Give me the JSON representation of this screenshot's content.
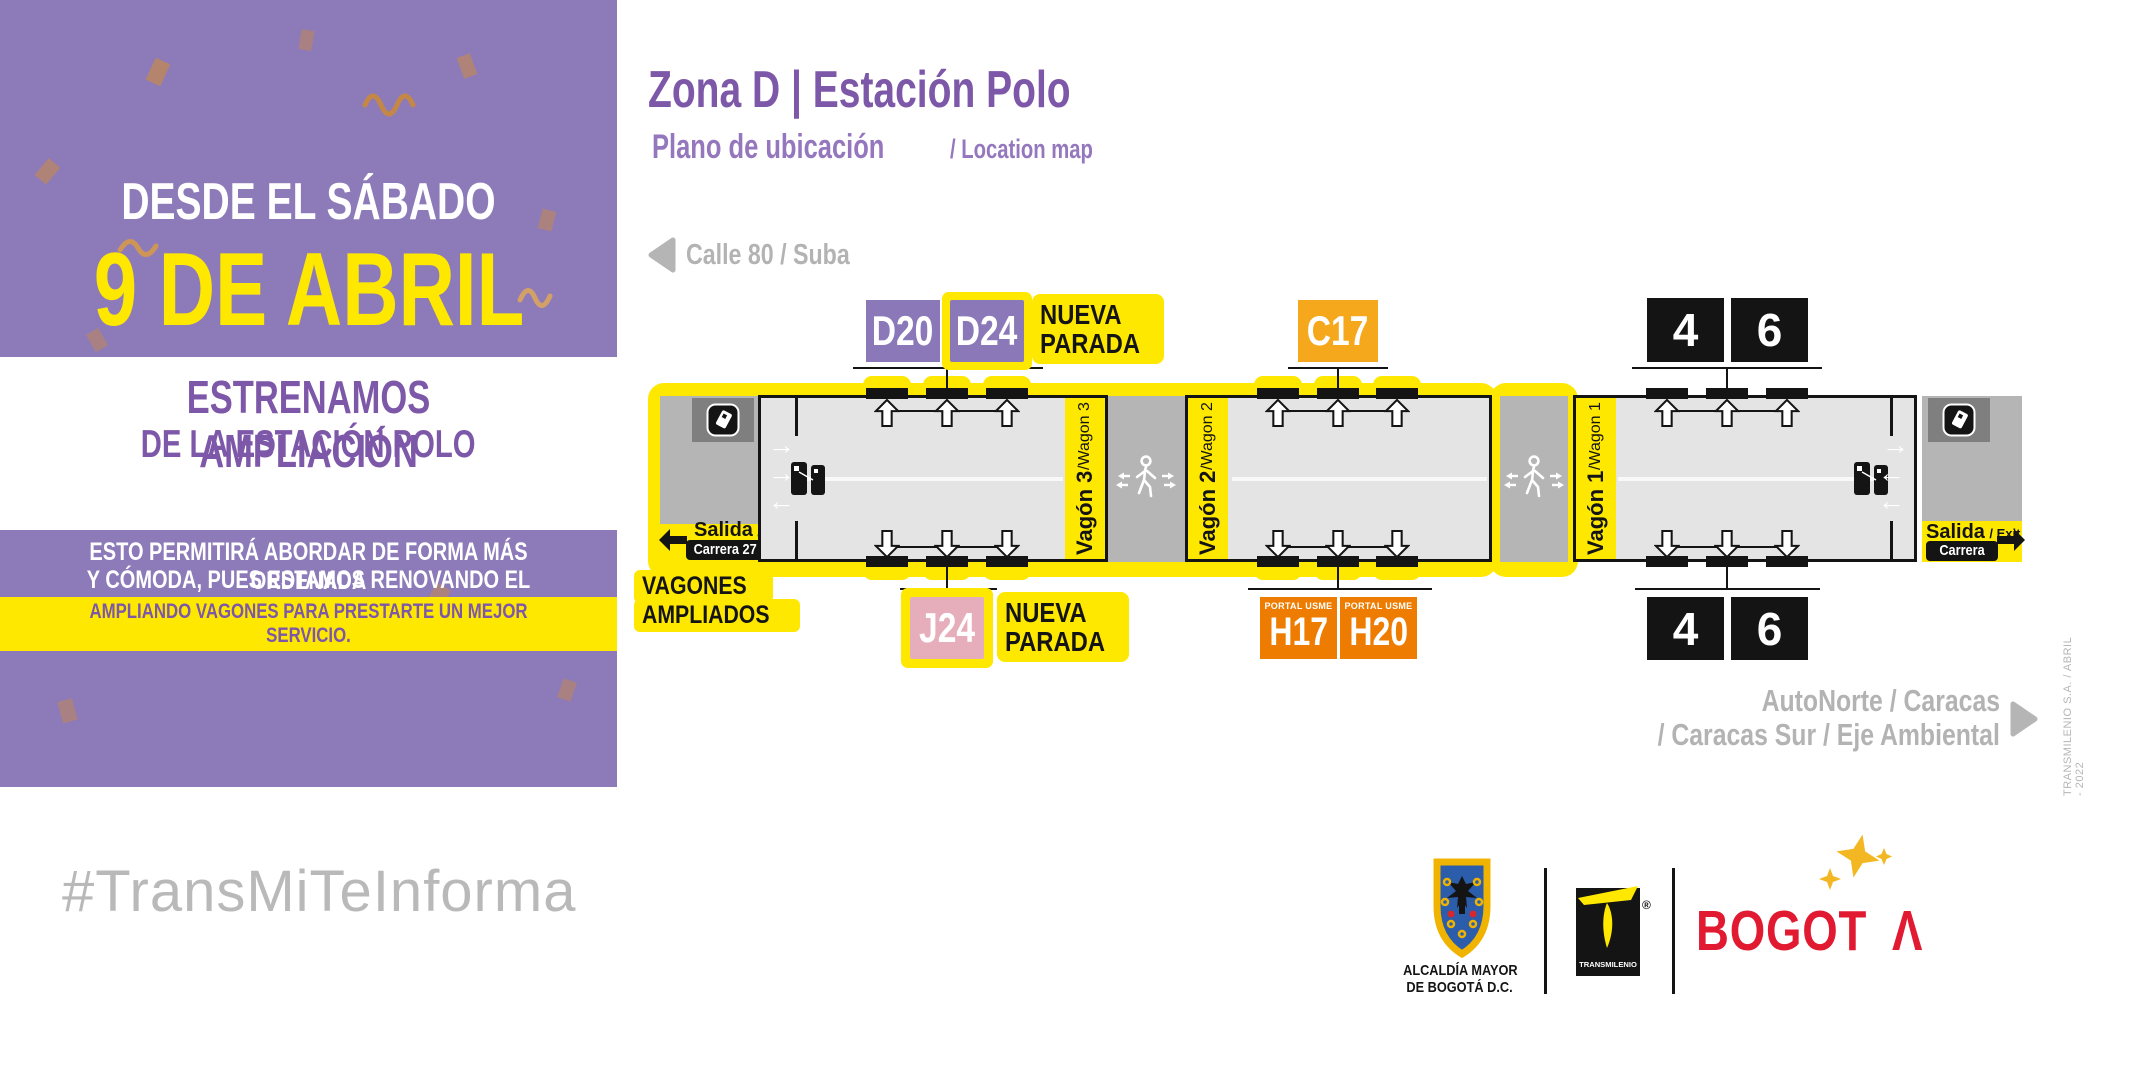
{
  "panel": {
    "line1": "DESDE EL SÁBADO",
    "line2": "9 DE ABRIL",
    "band1": "ESTRENAMOS AMPLIACIÓN",
    "band2": "DE LA ESTACIÓN POLO",
    "body1": "ESTO PERMITIRÁ ABORDAR DE FORMA MÁS ORDENADA",
    "body2": "Y CÓMODA, PUES ESTAMOS RENOVANDO EL SISTEMA,",
    "highlight": "AMPLIANDO VAGONES PARA PRESTARTE UN MEJOR SERVICIO."
  },
  "hashtag": "#TransMiTeInforma",
  "header": {
    "title": "Zona D | Estación Polo",
    "subtitle_es": "Plano de ubicación",
    "subtitle_en": "/ Location map"
  },
  "directions": {
    "west": "Calle 80 / Suba",
    "east_line1": "AutoNorte / Caracas",
    "east_line2": "/ Caracas Sur / Eje Ambiental"
  },
  "station": {
    "exits": {
      "left": {
        "salida": "Salida",
        "exit": "/ Exit",
        "street": "Carrera 27"
      },
      "right": {
        "salida": "Salida",
        "exit": "/ Exit",
        "street": "Carrera 28"
      }
    },
    "wagons": [
      {
        "name": "Vagón 3",
        "alt": " /Wagon 3"
      },
      {
        "name": "Vagón 2",
        "alt": " /Wagon 2"
      },
      {
        "name": "Vagón 1",
        "alt": " /Wagon 1"
      }
    ],
    "badges_top": [
      {
        "label": "D20"
      },
      {
        "label": "D24"
      },
      {
        "label": "C17"
      },
      {
        "label": "4"
      },
      {
        "label": "6"
      }
    ],
    "new_stop_top": [
      "NUEVA",
      "PARADA"
    ],
    "new_stop_bottom": [
      "NUEVA",
      "PARADA"
    ],
    "badges_bottom": [
      {
        "label": "J24"
      },
      {
        "sub": "PORTAL USME",
        "label": "H17"
      },
      {
        "sub": "PORTAL USME",
        "label": "H20"
      },
      {
        "label": "4"
      },
      {
        "label": "6"
      }
    ],
    "note": [
      "VAGONES",
      "AMPLIADOS"
    ]
  },
  "footer": {
    "alcaldia_line1": "ALCALDÍA MAYOR",
    "alcaldia_line2": "DE BOGOTÁ D.C.",
    "transmilenio": "TRANSMILENIO",
    "registered": "®",
    "bogota": "BOGOT",
    "bogota_a": "Λ"
  },
  "credit": "TRANSMILENIO S.A. / ABRIL - 2022",
  "colors": {
    "panel_purple": "#8d7bb9",
    "deep_purple": "#7d57a8",
    "yellow": "#FFE800",
    "amber": "#f6a81c",
    "orange": "#ee7c00",
    "pink": "#e6aebb",
    "red": "#e11931",
    "gray_text": "#b3b3b3"
  }
}
